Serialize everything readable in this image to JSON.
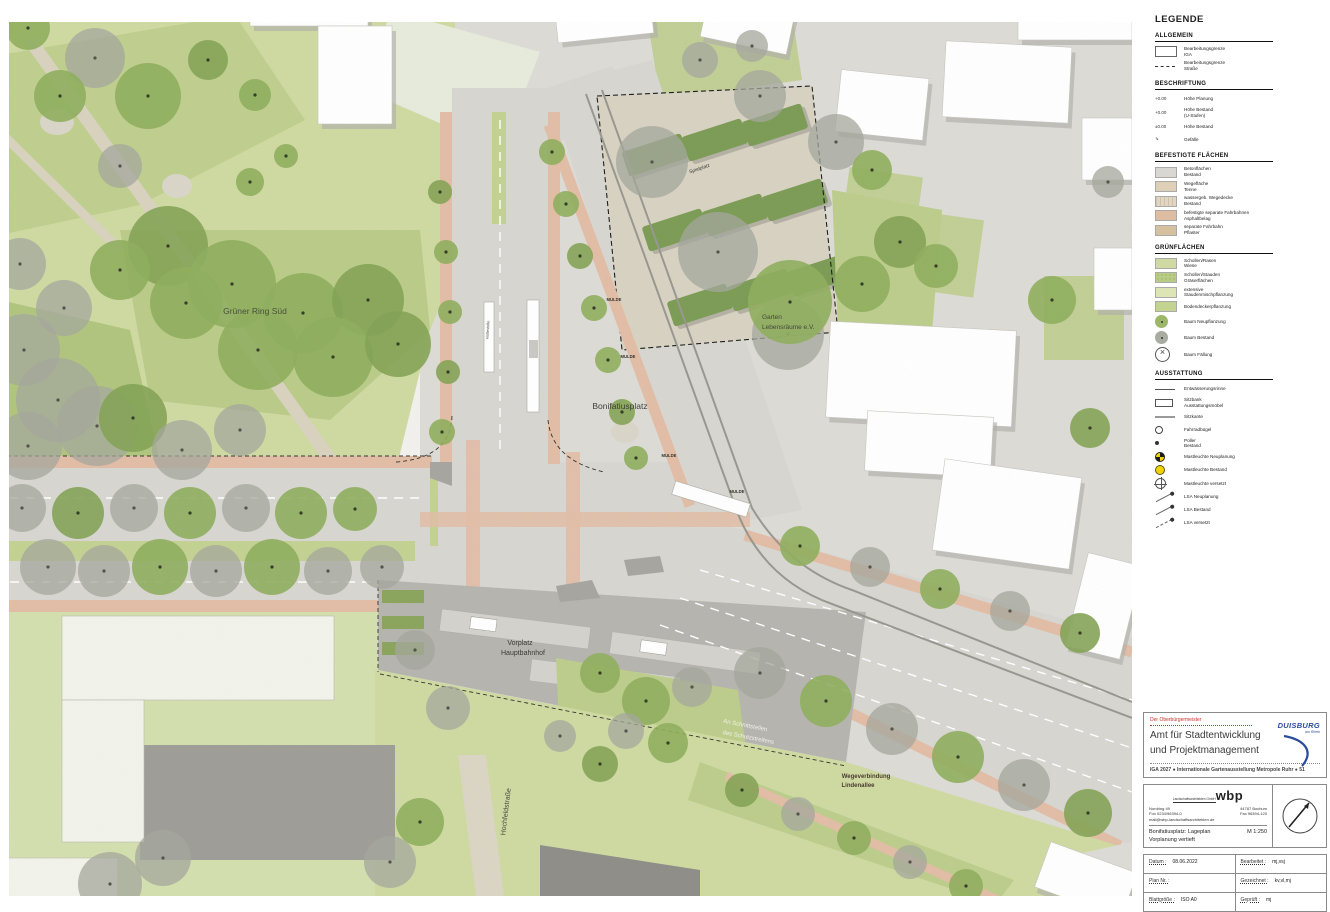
{
  "map": {
    "labels": [
      {
        "text": "Grüner Ring Süd",
        "x": 255,
        "y": 314,
        "size": 8.5,
        "rot": 0,
        "color": "#4a4f3e",
        "anchor": "middle"
      },
      {
        "text": "Bonifatiusplatz",
        "x": 620,
        "y": 409,
        "size": 8.5,
        "rot": 0,
        "color": "#3f4038",
        "anchor": "middle"
      },
      {
        "text": "Garten",
        "x": 762,
        "y": 319,
        "size": 6.5,
        "rot": 0,
        "color": "#44483a",
        "anchor": "start"
      },
      {
        "text": "Lebensräume e.V.",
        "x": 762,
        "y": 329,
        "size": 6.5,
        "rot": 0,
        "color": "#44483a",
        "anchor": "start"
      },
      {
        "text": "Spielplatz",
        "x": 700,
        "y": 170,
        "size": 5,
        "rot": -19,
        "color": "#3c3c36",
        "anchor": "middle"
      },
      {
        "text": "Vorplatz",
        "x": 520,
        "y": 645,
        "size": 7,
        "rot": 0,
        "color": "#3c3c36",
        "anchor": "middle"
      },
      {
        "text": "Hauptbahnhof",
        "x": 523,
        "y": 655,
        "size": 7,
        "rot": 0,
        "color": "#3c3c36",
        "anchor": "middle"
      },
      {
        "text": "An Schnittstellen",
        "x": 745,
        "y": 727,
        "size": 6,
        "rot": 11,
        "color": "#f2f1ea",
        "anchor": "middle"
      },
      {
        "text": "des Schutzstreifens",
        "x": 748,
        "y": 739,
        "size": 6,
        "rot": 11,
        "color": "#f2f1ea",
        "anchor": "middle"
      },
      {
        "text": "Wegeverbindung",
        "x": 866,
        "y": 778,
        "size": 6,
        "rot": 0,
        "color": "#4a3c30",
        "anchor": "middle",
        "weight": "bold"
      },
      {
        "text": "Lindenallee",
        "x": 858,
        "y": 787,
        "size": 6,
        "rot": 0,
        "color": "#4a3c30",
        "anchor": "middle",
        "weight": "bold"
      },
      {
        "text": "Hochfeldstraße",
        "x": 508,
        "y": 812,
        "size": 7,
        "rot": -83,
        "color": "#4a4a42",
        "anchor": "middle"
      },
      {
        "text": "MULDE",
        "x": 614,
        "y": 301,
        "size": 4.2,
        "rot": 0,
        "color": "#33352a",
        "anchor": "middle",
        "weight": "bold"
      },
      {
        "text": "MULDE",
        "x": 628,
        "y": 358,
        "size": 4.2,
        "rot": 0,
        "color": "#33352a",
        "anchor": "middle",
        "weight": "bold"
      },
      {
        "text": "MULDE",
        "x": 669,
        "y": 457,
        "size": 4.2,
        "rot": 0,
        "color": "#33352a",
        "anchor": "middle",
        "weight": "bold"
      },
      {
        "text": "MULDE",
        "x": 737,
        "y": 493,
        "size": 4.2,
        "rot": 0,
        "color": "#33352a",
        "anchor": "middle",
        "weight": "bold"
      },
      {
        "text": "Haltestelle",
        "x": 489,
        "y": 330,
        "size": 4,
        "rot": -87,
        "color": "#55554e",
        "anchor": "middle"
      }
    ]
  },
  "colors": {
    "park_light": "#cfdaa2",
    "park_mid": "#bccd8b",
    "park_dark": "#a9bf75",
    "urban": "#dcdbd6",
    "road": "#d7d6d1",
    "salmon": "#e2bda6",
    "garden_beige": "#d8d2c2",
    "hedge": "#7b9c55",
    "bus_gray": "#b5b4ae",
    "tree_green": "#8fae5d",
    "tree_gray": "#a4a79c",
    "accent_red": "#c23324",
    "accent_blue": "#2a4d9b"
  },
  "legend": {
    "title": "LEGENDE",
    "sections": [
      {
        "title": "ALLGEMEIN",
        "items": [
          {
            "swatch": "boundary-solid",
            "lines": [
              "Bearbeitungsgrenze",
              "IGA"
            ]
          },
          {
            "swatch": "boundary-dashed",
            "lines": [
              "Bearbeitungsgrenze",
              "Straße"
            ]
          }
        ]
      },
      {
        "title": "BESCHRIFTUNG",
        "items": [
          {
            "swatch": "height-plan",
            "symbol_text": "+0.00",
            "lines": [
              "Höhe Planung"
            ]
          },
          {
            "swatch": "height-bestand-stufen",
            "symbol_text": "+0.00",
            "lines": [
              "Höhe Bestand",
              "(U-Stufen)"
            ]
          },
          {
            "swatch": "height-bestand",
            "symbol_text": "±0.00",
            "lines": [
              "Höhe Bestand"
            ]
          },
          {
            "swatch": "slope-arrow",
            "symbol_text": "⇘",
            "lines": [
              "Gefälle"
            ]
          }
        ]
      },
      {
        "title": "BEFESTIGTE FLÄCHEN",
        "items": [
          {
            "swatch": "concrete",
            "lines": [
              "Betonflächen",
              "Bestand"
            ]
          },
          {
            "swatch": "tenne",
            "lines": [
              "Wegefläche",
              "Tenne"
            ]
          },
          {
            "swatch": "pflaster",
            "lines": [
              "wassergeb. Wegedecke",
              "Bestand"
            ]
          },
          {
            "swatch": "radweg",
            "lines": [
              "befestigte separate Fahrbahnen",
              "Asphaltbelag"
            ]
          },
          {
            "swatch": "fahrbahn",
            "lines": [
              "separate Fahrbahn",
              "Pflaster"
            ]
          }
        ]
      },
      {
        "title": "GRÜNFLÄCHEN",
        "items": [
          {
            "swatch": "rasen",
            "lines": [
              "Schollen/Rasen",
              "Wiese"
            ]
          },
          {
            "swatch": "stauden",
            "lines": [
              "Schollen/Stauden",
              "Gräserflächen"
            ]
          },
          {
            "swatch": "misch",
            "lines": [
              "extensive",
              "Staudenmischpflanzung"
            ]
          },
          {
            "swatch": "bodendecker",
            "lines": [
              "Bodendeckerpflanzung"
            ]
          },
          {
            "swatch": "baum-neu",
            "lines": [
              "Baum Neupflanzung"
            ]
          },
          {
            "swatch": "baum-bestand",
            "lines": [
              "Baum Bestand"
            ]
          },
          {
            "swatch": "baum-faellung",
            "lines": [
              "Baum Fällung"
            ]
          }
        ]
      },
      {
        "title": "AUSSTATTUNG",
        "items": [
          {
            "swatch": "rinne",
            "lines": [
              "Entwässerungsrinne"
            ]
          },
          {
            "swatch": "sitzbank",
            "lines": [
              "Sitzbank",
              "Ausstattungsmöbel"
            ]
          },
          {
            "swatch": "sitzkante",
            "lines": [
              "Sitzkante"
            ]
          },
          {
            "swatch": "fahrradbuegel",
            "lines": [
              "Fahrradbügel"
            ]
          },
          {
            "swatch": "poller",
            "lines": [
              "Poller",
              "Bestand"
            ]
          },
          {
            "swatch": "leuchte-neu",
            "lines": [
              "Mastleuchte Neuplanung"
            ]
          },
          {
            "swatch": "leuchte-bestand",
            "lines": [
              "Mastleuchte Bestand"
            ]
          },
          {
            "swatch": "leuchte-versetzt",
            "lines": [
              "Mastleuchte versetzt"
            ]
          },
          {
            "swatch": "lsa-neu",
            "lines": [
              "LSA Neuplanung"
            ]
          },
          {
            "swatch": "lsa-bestand",
            "lines": [
              "LSA Bestand"
            ]
          },
          {
            "swatch": "lsa-versetzt",
            "lines": [
              "LSA versetzt"
            ]
          }
        ]
      }
    ]
  },
  "titleblock": {
    "client_small": "Der Oberbürgermeister",
    "dept1": "Amt für Stadtentwicklung",
    "dept2": "und Projektmanagement",
    "project_line": "IGA 2027 ● Internationale Gartenausstellung Metropole Ruhr ● 51",
    "city_logo": "DUISBURG",
    "city_logo_sub": "am Rhein",
    "office": {
      "name": "wbp",
      "sub": "Landschaftsarchitekten GmbH",
      "addr_l1": "Nordring 49",
      "addr_r1": "44787 Bochum",
      "addr_l2": "Fon 0234/96394-0",
      "addr_r2": "Fax 96394-120",
      "mail": "mail@wbp-landschaftsarchitekten.de"
    },
    "drawing": {
      "line1": "Bonifatiusplatz: Lageplan",
      "line2": "Vorplanung vertieft",
      "scale": "M 1:250"
    },
    "fields": {
      "datum_label": "Datum :",
      "datum": "08.06.2022",
      "bearbeitet_label": "Bearbeitet :",
      "bearbeitet": "mj,vsj",
      "plannr_label": "Plan Nr. :",
      "plannr": "",
      "gezeichnet_label": "Gezeichnet :",
      "gezeichnet": "kv,vl,mj",
      "blatt_label": "Blattgröße :",
      "blatt": "ISO A0",
      "geprueft_label": "Geprüft :",
      "geprueft": "mj"
    }
  }
}
